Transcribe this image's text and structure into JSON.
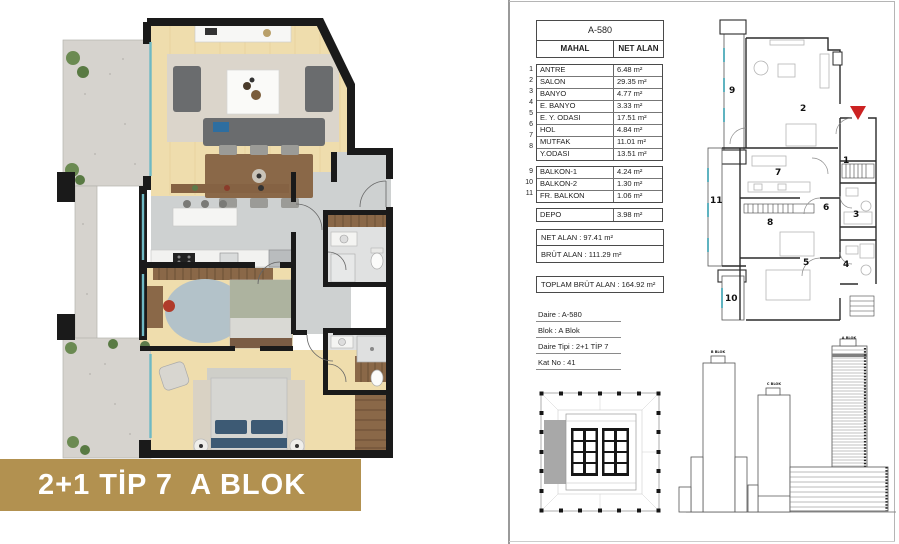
{
  "banner": {
    "label": "2+1 TİP 7  A BLOK",
    "bg_color": "#b29150",
    "text_color": "#ffffff"
  },
  "unit_table": {
    "header": "A-580",
    "col_room": "MAHAL",
    "col_area": "NET ALAN",
    "rows": [
      {
        "no": "1",
        "name": "ANTRE",
        "area": "6.48 m²"
      },
      {
        "no": "2",
        "name": "SALON",
        "area": "29.35 m²"
      },
      {
        "no": "3",
        "name": "BANYO",
        "area": "4.77 m²"
      },
      {
        "no": "4",
        "name": "E. BANYO",
        "area": "3.33 m²"
      },
      {
        "no": "5",
        "name": "E. Y. ODASI",
        "area": "17.51 m²"
      },
      {
        "no": "6",
        "name": "HOL",
        "area": "4.84 m²"
      },
      {
        "no": "7",
        "name": "MUTFAK",
        "area": "11.01 m²"
      },
      {
        "no": "8",
        "name": "Y.ODASI",
        "area": "13.51 m²"
      }
    ],
    "balcony_rows": [
      {
        "no": "9",
        "name": "BALKON-1",
        "area": "4.24 m²"
      },
      {
        "no": "10",
        "name": "BALKON-2",
        "area": "1.30 m²"
      },
      {
        "no": "11",
        "name": "FR. BALKON",
        "area": "1.06 m²"
      }
    ],
    "depo": {
      "name": "DEPO",
      "area": "3.98 m²"
    },
    "net_alan": "NET ALAN : 97.41 m²",
    "brut_alan": "BRÜT ALAN : 111.29 m²",
    "toplam_brut_alan": "TOPLAM BRÜT ALAN : 164.92 m²"
  },
  "unit_info": {
    "daire": "Daire : A-580",
    "blok": "Blok : A Blok",
    "daire_tipi": "Daire Tipi : 2+1 TİP 7",
    "kat_no": "Kat No : 41"
  },
  "schematic": {
    "room_numbers": [
      "1",
      "2",
      "3",
      "4",
      "5",
      "6",
      "7",
      "8",
      "9",
      "10",
      "11"
    ],
    "entrance_marker_color": "#cc2222",
    "glass_color": "#5fb3c0"
  },
  "elevation": {
    "labels": [
      "B BLOK",
      "C BLOK",
      "A BLOK"
    ],
    "highlight_floor_color": "#808080"
  },
  "colors": {
    "wall": "#1a1a1a",
    "wood_floor": "#efddad",
    "tile_floor": "#ced1d1",
    "balcony_stone": "#d6d3ce",
    "plant_green": "#6b8a52",
    "accent_gold": "#b29150"
  }
}
